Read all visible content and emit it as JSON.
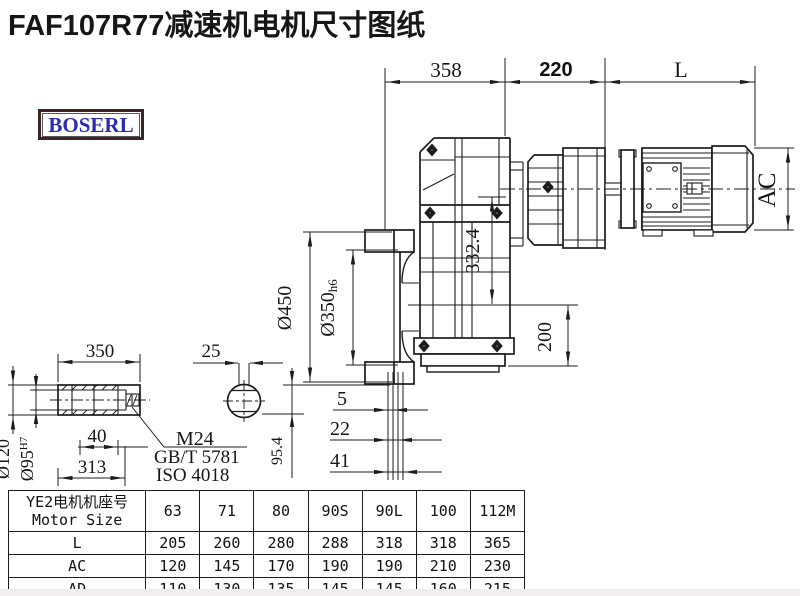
{
  "title": "FAF107R77减速机电机尺寸图纸",
  "logo": {
    "text": "BOSERL"
  },
  "colors": {
    "line": "#1c1c1c",
    "logo_text": "#2b2bb4",
    "logo_border": "#3f2222"
  },
  "dims": {
    "top_width": "358",
    "adapter_width": "220",
    "motor_length": "L",
    "motor_height": "AC",
    "flange_od": "Ø450",
    "spigot_d": "Ø350",
    "spigot_fit": "h6",
    "case_height": "332.4",
    "base_height": "200",
    "offset_5": "5",
    "offset_22": "22",
    "offset_41": "41",
    "shaft_drop": "95.4",
    "sleeve_length": "350",
    "key_width": "25",
    "sleeve_od": "Ø120",
    "bore_d": "Ø95",
    "bore_fit": "H7",
    "dim_40": "40",
    "dim_313": "313",
    "bolt": "M24",
    "bolt_std1": "GB/T 5781",
    "bolt_std2": "ISO 4018"
  },
  "table": {
    "header_line1": "YE2电机机座号",
    "header_line2": "Motor Size",
    "columns": [
      "63",
      "71",
      "80",
      "90S",
      "90L",
      "100",
      "112M"
    ],
    "rows": [
      {
        "label": "L",
        "values": [
          "205",
          "260",
          "280",
          "288",
          "318",
          "318",
          "365"
        ]
      },
      {
        "label": "AC",
        "values": [
          "120",
          "145",
          "170",
          "190",
          "190",
          "210",
          "230"
        ]
      },
      {
        "label": "AD",
        "values": [
          "110",
          "130",
          "135",
          "145",
          "145",
          "160",
          "215"
        ]
      }
    ]
  }
}
